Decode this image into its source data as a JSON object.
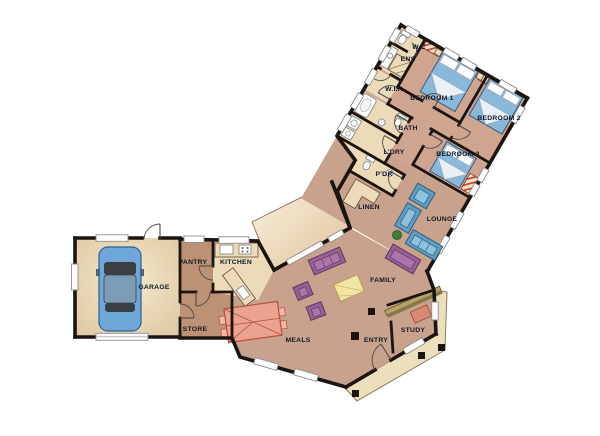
{
  "rooms": {
    "wc": "W.C",
    "ens": "ENS",
    "wir": "W.I.R",
    "bedroom1": "BEDROOM 1",
    "bedroom2": "BEDROOM 2",
    "bath": "BATH",
    "ldry": "L'DRY",
    "bedroom3": "BEDROOM 3",
    "pdr": "P'DR",
    "linen": "LINEN",
    "lounge": "LOUNGE",
    "pantry": "PANTRY",
    "kitchen": "KITCHEN",
    "garage": "GARAGE",
    "store": "STORE",
    "meals": "MEALS",
    "family": "FAMILY",
    "entry": "ENTRY",
    "study": "STUDY"
  },
  "colors": {
    "wall": "#1b1410",
    "floor_main": "#c8a28c",
    "floor_bedroom": "#cfa590",
    "floor_service": "#bd9274",
    "cream": "#ecdbb8",
    "garage_light": "#f3e9cc",
    "garage_dark": "#dcc49e",
    "deck_light": "#faf3df",
    "deck_dark": "#dec19a",
    "veranda": "#ebdfbc",
    "bed": "#8ab8da",
    "sofa_lounge": "#5d9ec2",
    "sofa_family": "#9a5e96",
    "table_meals": "#eca290",
    "table_meals_line": "#b4503c",
    "table_yellow": "#f0e5a5",
    "car": "#6ea7d8",
    "plant": "#3e7d3b",
    "label": "#101828"
  }
}
